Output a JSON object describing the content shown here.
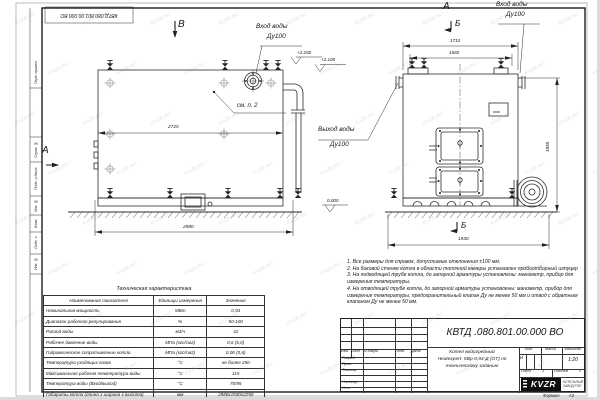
{
  "watermark": {
    "text": "KVZR.RU"
  },
  "frame": {
    "stamp_top": "КВТД.080.801.00.000 ВО",
    "side_labels": {
      "perv": "Перв. примен.",
      "sprav": "Справ. №",
      "podp1": "Подп. и дата",
      "inv_dubl": "Инв. № дубл.",
      "vzam": "Взам. инв. №",
      "podp2": "Подп. и дата",
      "inv_podl": "Инв. № подл."
    },
    "format_label": "Формат",
    "format_value": "А3"
  },
  "drawing": {
    "view_b": "В",
    "view_a": "А",
    "section_b": "Б",
    "inlet_line1": "Вход воды",
    "inlet_line2": "Ду100",
    "outlet_line1": "Выход воды",
    "outlet_line2": "Ду100",
    "see_note": "см. п. 2",
    "elev_top1": "+2.250",
    "elev_top2": "+2.100",
    "elev_zero": "0.000",
    "dims": {
      "front_width": "2725",
      "front_base": "2980",
      "side_top_outer": "1710",
      "side_top_inner": "1560",
      "side_height": "1855",
      "side_base": "1930"
    }
  },
  "spec_table": {
    "title": "Техническая характеристика",
    "col_name": "Наименование показателя",
    "col_units": "Единицы измерения",
    "col_value": "Значение",
    "rows": [
      {
        "name": "Номинальная мощность",
        "units": "МВт",
        "value": "0,93"
      },
      {
        "name": "Диапазон рабочего регулирования",
        "units": "%",
        "value": "50-100"
      },
      {
        "name": "Расход воды",
        "units": "м3/ч",
        "value": "32"
      },
      {
        "name": "Рабочее давление воды",
        "units": "МПа (кгс/см2)",
        "value": "0,6 (6,0)"
      },
      {
        "name": "Гидравлическое сопротивление котла",
        "units": "МПа (кгс/см2)",
        "value": "0,06 (0,6)"
      },
      {
        "name": "Температура уходящих газов",
        "units": "°С",
        "value": "не более 250"
      },
      {
        "name": "Максимальная рабочая температура воды",
        "units": "°С",
        "value": "115"
      },
      {
        "name": "Температура воды (Вход/выход)",
        "units": "°С",
        "value": "70/95"
      },
      {
        "name": "Габариты котла (длина х ширина х высота)",
        "units": "мм",
        "value": "2980х1930х2250"
      }
    ]
  },
  "notes": {
    "n1": "1. Все размеры для справок, допустимые отклонения ±100 мм.",
    "n2": "2. На боковой стенке котла в области топочной камеры установлен пробоотборный штуцер",
    "n3": "3. На подводящей трубе котла, до запорной арматуры установлены: манометр, прибор для измерения температуры.",
    "n4": "4. На отводящей трубе котла, до запорной арматуры установлены: манометр, прибор для измерения температуры, предохранительный клапан Ду не менее 50 мм и отвод с обратным клапаном Ду не менее 50 мм."
  },
  "title_block": {
    "doc_number": "КВТД .080.801.00.000  ВО",
    "product_line1": "Котел водогрейный",
    "product_line2": "Heatexpert- КВр-0,93-Д (ОТ) по",
    "product_line3": "техническому заданию",
    "col_izm": "Изм.",
    "col_list": "Лист",
    "col_docum": "N докум.",
    "col_podp": "Подп.",
    "col_data": "Дата",
    "row_razrab": "Разраб.",
    "row_prov": "Пров.",
    "row_tkontr": "Т.контр.",
    "row_nkontr": "Н.контр.",
    "row_utv": "Утв.",
    "lit_label": "Лит.",
    "lit_value": "И",
    "massa_label": "Масса",
    "masshtab_label": "Масштаб",
    "scale_value": "1:20",
    "sheet_label": "Лист",
    "sheet_value": "1",
    "sheets_label": "Листов",
    "sheets_value": "2",
    "logo_text": "KVZR",
    "logo_sub1": "КОТЕЛЬНЫЙ",
    "logo_sub2": "ЗАВОД РЭП"
  }
}
